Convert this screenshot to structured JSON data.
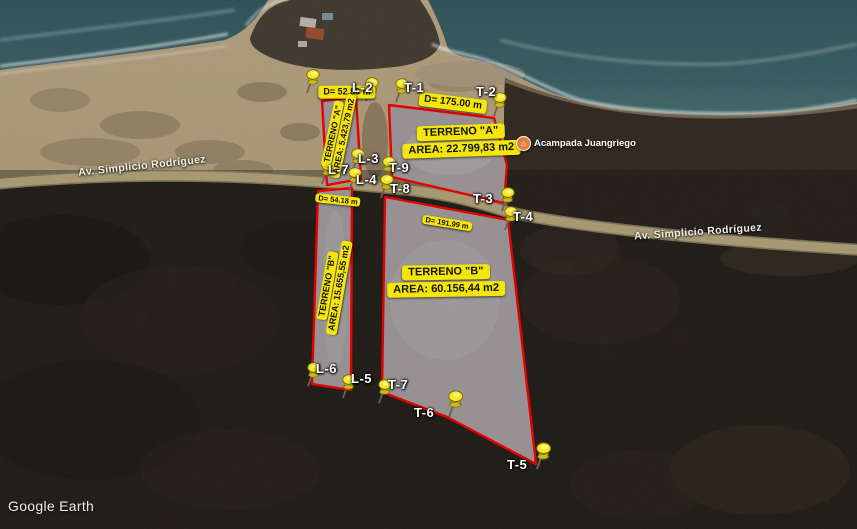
{
  "app": {
    "watermark": "Google Earth"
  },
  "road": {
    "name": "Av. Simplicio Rodríguez"
  },
  "poi": {
    "name": "Acampada Juangriego",
    "icon": "lodging-pin"
  },
  "parcels": {
    "a": {
      "name": "TERRENO \"A\"",
      "area": "AREA: 22.799,83 m2"
    },
    "a_strip": {
      "name": "TERRENO \"A\"",
      "area": "AREA: 5.423,79 m2"
    },
    "b": {
      "name": "TERRENO \"B\"",
      "area": "AREA: 60.156,44 m2"
    },
    "b_strip": {
      "name": "TERRENO \"B\"",
      "area": "AREA: 15.655,55 m2"
    }
  },
  "distances": {
    "d1": "D= 52.80 m",
    "d2": "D= 175.00 m",
    "d3": "D= 54.18 m",
    "d4": "D= 191,99 m"
  },
  "pins": [
    {
      "label": "L-2"
    },
    {
      "label": "T-1"
    },
    {
      "label": "T-2"
    },
    {
      "label": "L-3"
    },
    {
      "label": "T-9"
    },
    {
      "label": "L-7"
    },
    {
      "label": "L-4"
    },
    {
      "label": "T-8"
    },
    {
      "label": "T-3"
    },
    {
      "label": "T-4"
    },
    {
      "label": "L-6"
    },
    {
      "label": "L-5"
    },
    {
      "label": "T-7"
    },
    {
      "label": "T-6"
    },
    {
      "label": "T-5"
    }
  ],
  "colors": {
    "parcel_outline": "#e60000",
    "label_bg": "#f4e50b",
    "pushpin": "#f6e72b",
    "ocean": "#35666b",
    "road": "#c9b684",
    "parcel_fill": "#b4adaf"
  }
}
